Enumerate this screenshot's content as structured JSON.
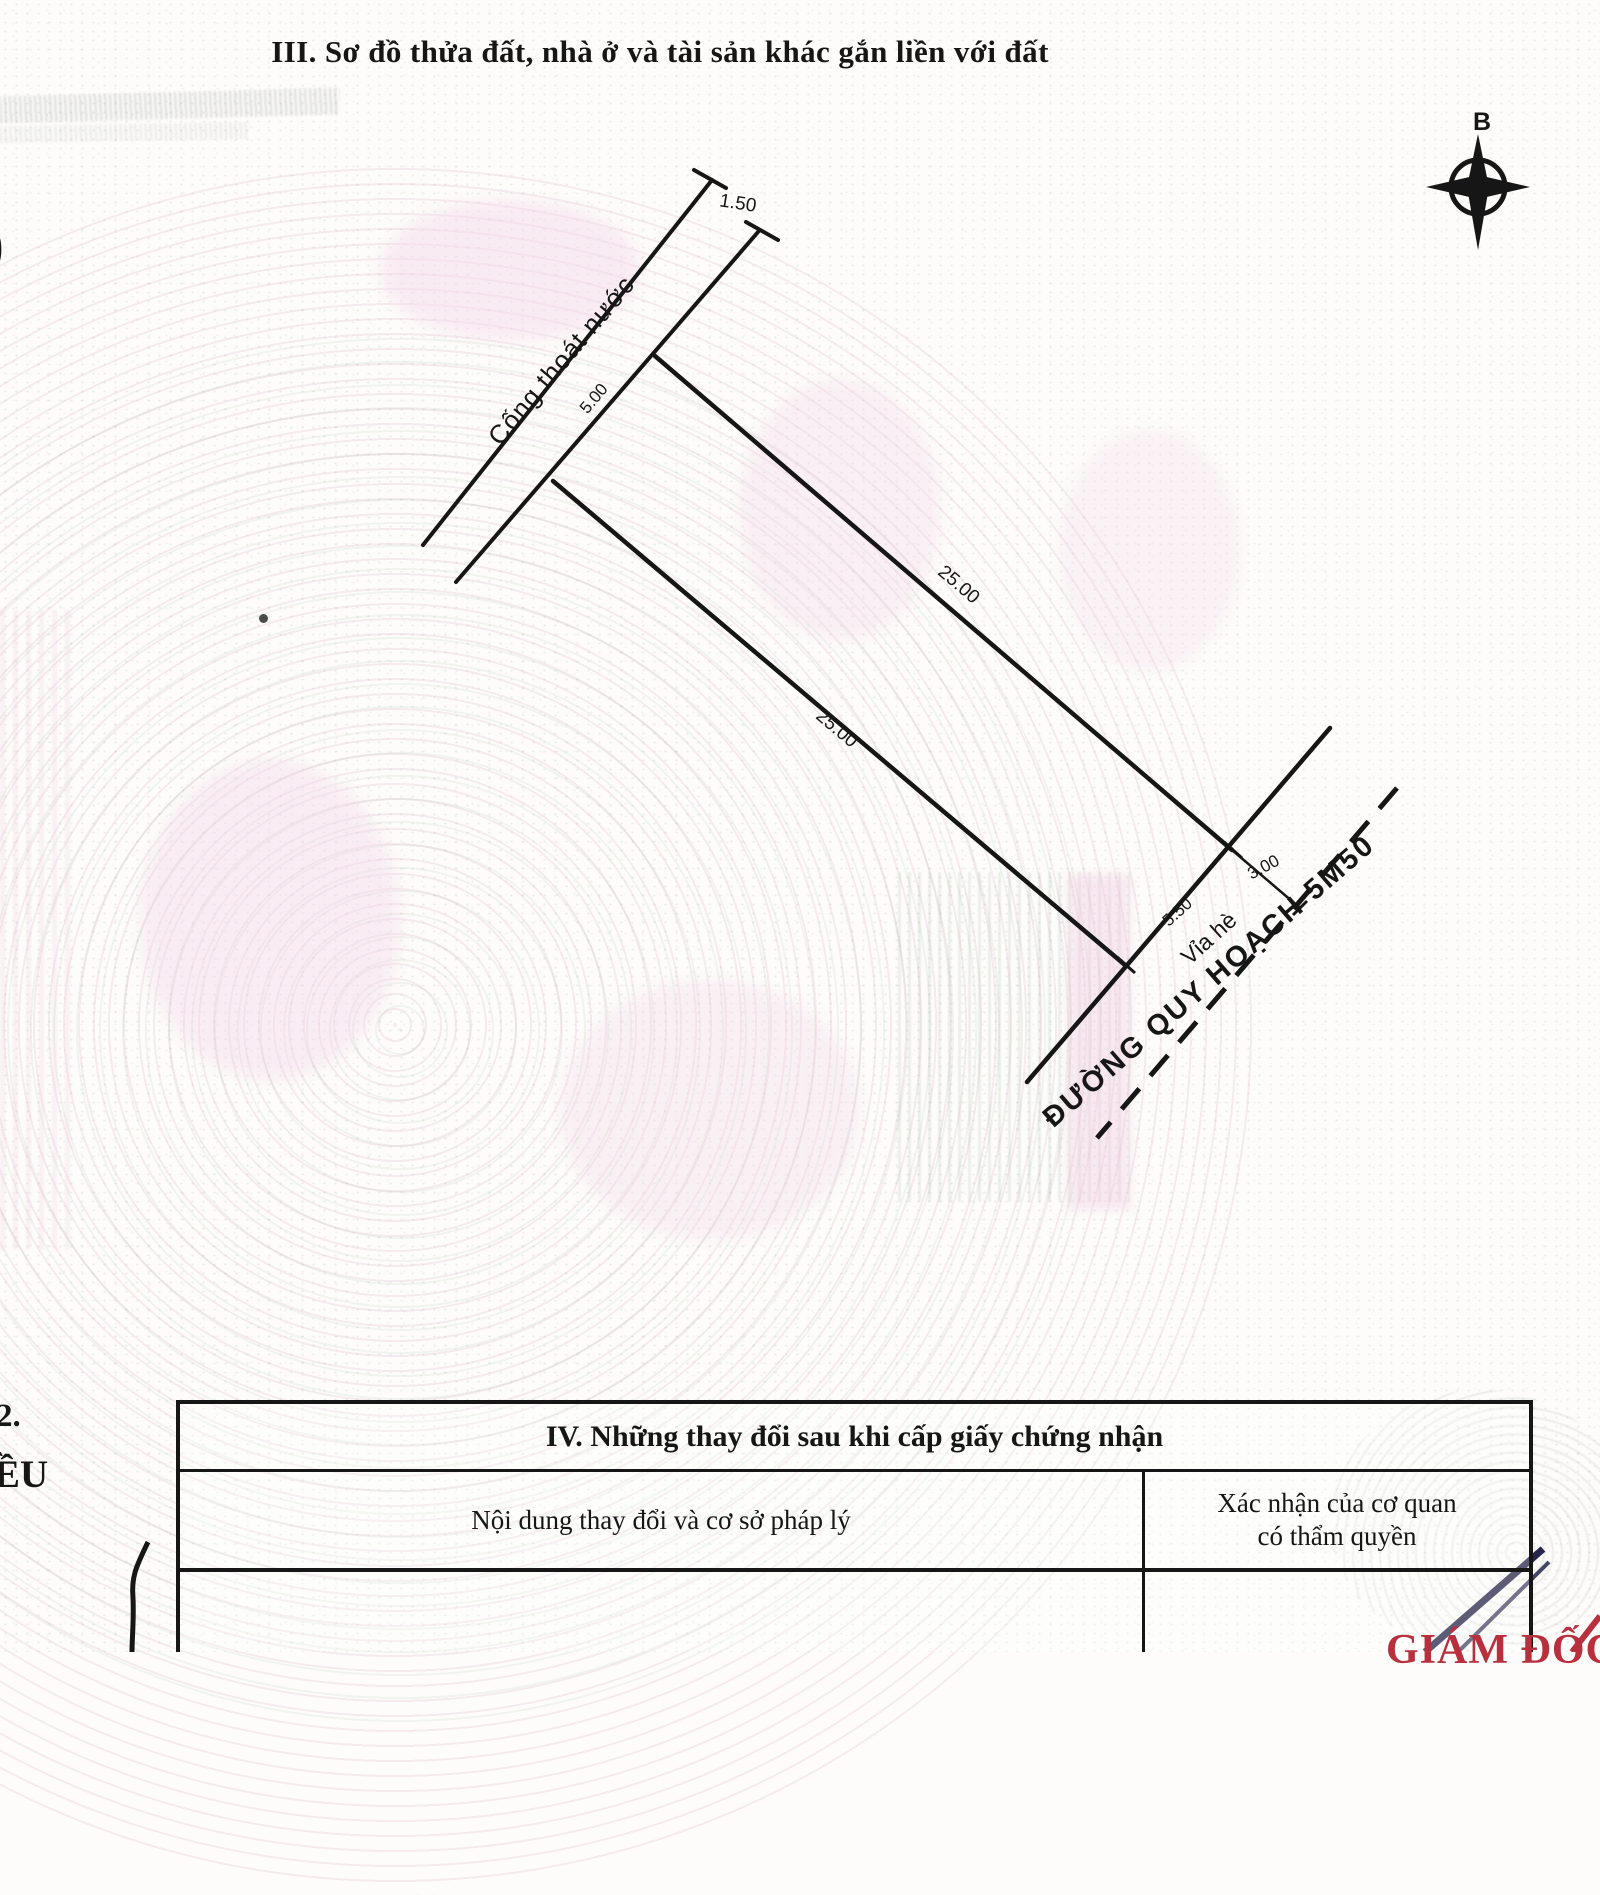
{
  "document": {
    "section_iii_title": "III. Sơ đồ thửa đất, nhà ở và tài sản khác gắn liền với đất",
    "edge_fragments": {
      "paren": ")",
      "item_number": "2.",
      "word_fragment": "ỀU"
    }
  },
  "diagram": {
    "compass_north_label": "B",
    "drain_label": "Cống thoát nước",
    "drain_width": "1.50",
    "rear_edge_dim": "5.00",
    "upper_side_dim": "25.00",
    "lower_side_dim": "25.00",
    "front_edge_dim": "5.50",
    "sidewalk_label": "Vỉa hè",
    "sidewalk_width_dim": "3.00",
    "road_label": "ĐƯỜNG QUY HOẠCH 5M50"
  },
  "changes_table": {
    "title": "IV. Những thay đổi sau khi cấp giấy chứng nhận",
    "column_1_header": "Nội dung thay đổi và cơ sở pháp lý",
    "column_2_header_line1": "Xác nhận của cơ quan",
    "column_2_header_line2": "có thẩm quyền"
  },
  "signature_area": {
    "title_red": "GIÁM ĐỐC"
  },
  "colors": {
    "ink": "#161616",
    "red_stamp": "#b82f3d",
    "pen_blue": "#26264a",
    "watermark_pink": "#f0d4e4",
    "watermark_green": "#94b096"
  }
}
